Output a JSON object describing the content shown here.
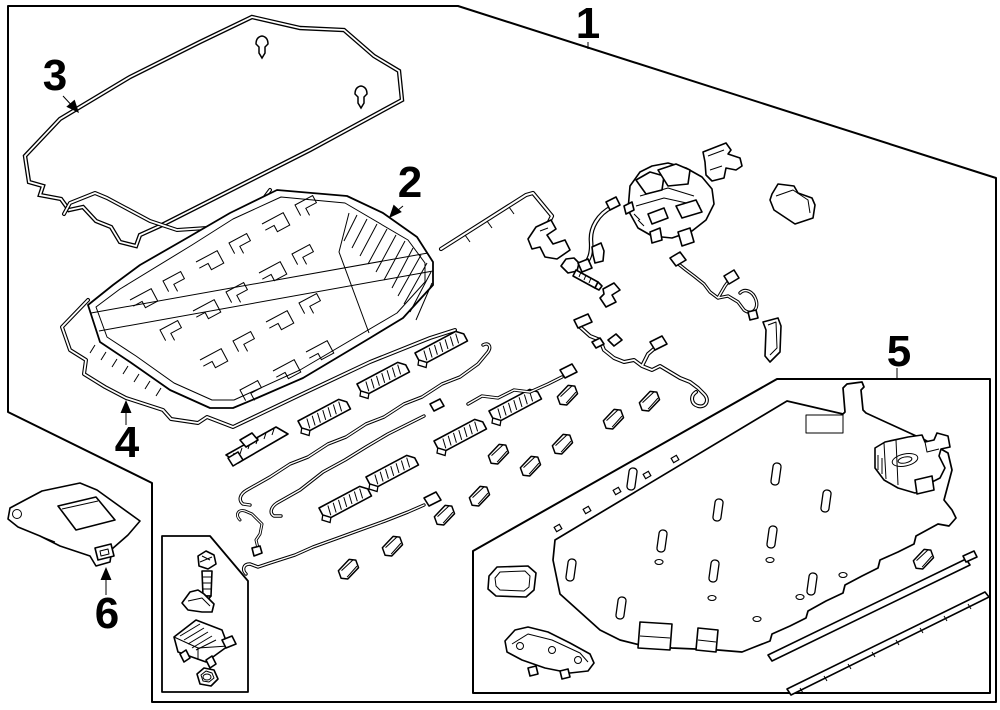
{
  "page": {
    "background": "#ffffff",
    "line_color": "#000000"
  },
  "diagram": {
    "kind": "exploded-parts-line-drawing",
    "subject": "hybrid drive battery pack components",
    "callouts": [
      {
        "label": "1",
        "part": "battery-pack-assembly-boundary"
      },
      {
        "label": "2",
        "part": "battery-module-frame-cover"
      },
      {
        "label": "3",
        "part": "service-lid-seal"
      },
      {
        "label": "4",
        "part": "battery-lower-tray"
      },
      {
        "label": "5",
        "part": "battery-case-lower"
      },
      {
        "label": "6",
        "part": "mounting-bracket"
      }
    ]
  }
}
